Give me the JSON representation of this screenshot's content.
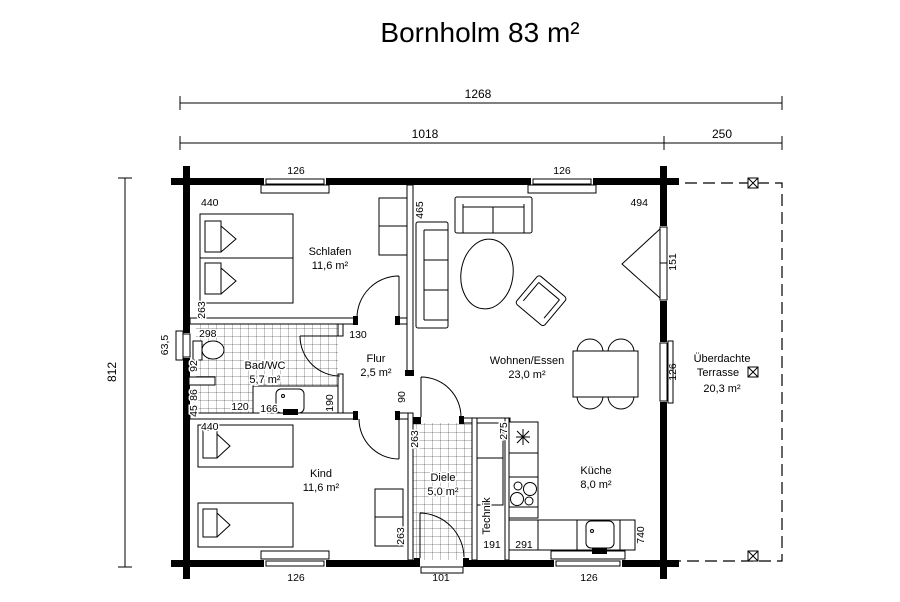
{
  "title": "Bornholm 83 m²",
  "colors": {
    "ink": "#000000",
    "paper": "#ffffff"
  },
  "rooms": {
    "schlafen": {
      "name": "Schlafen",
      "area": "11,6 m²"
    },
    "bad": {
      "name": "Bad/WC",
      "area": "5,7 m²"
    },
    "flur": {
      "name": "Flur",
      "area": "2,5 m²"
    },
    "wohnen": {
      "name": "Wohnen/Essen",
      "area": "23,0 m²"
    },
    "kind": {
      "name": "Kind",
      "area": "11,6 m²"
    },
    "diele": {
      "name": "Diele",
      "area": "5,0 m²"
    },
    "kueche": {
      "name": "Küche",
      "area": "8,0 m²"
    },
    "technik": {
      "name": "Technik"
    },
    "terrasse": {
      "line1": "Überdachte",
      "line2": "Terrasse",
      "area": "20,3 m²"
    }
  },
  "dims": {
    "total_width": "1268",
    "house_width": "1018",
    "terrace_width": "250",
    "total_depth": "812",
    "window_top_left": "126",
    "window_top_right": "126",
    "schlafen_width": "440",
    "partition_length": "465",
    "wohnen_width": "494",
    "schlafen_depth": "263",
    "bad_width": "298",
    "schlafen_door": "130",
    "bath_window": "63,5",
    "bad_wall_upper": "92",
    "bad_wall_lower": "86",
    "bad_wall_small": "45",
    "bad_cabinet": "120",
    "bad_sink": "166",
    "bad_door": "190",
    "flur_opening": "90",
    "terrace_door": "151",
    "window_right": "126",
    "kind_width": "440",
    "kind_depth": "263",
    "diele_wall": "263",
    "kueche_wall": "275",
    "technik_width": "191",
    "kueche_counter": "291",
    "kueche_depth": "740",
    "window_bottom_left": "126",
    "entrance_door": "101",
    "window_bottom_right": "126"
  }
}
